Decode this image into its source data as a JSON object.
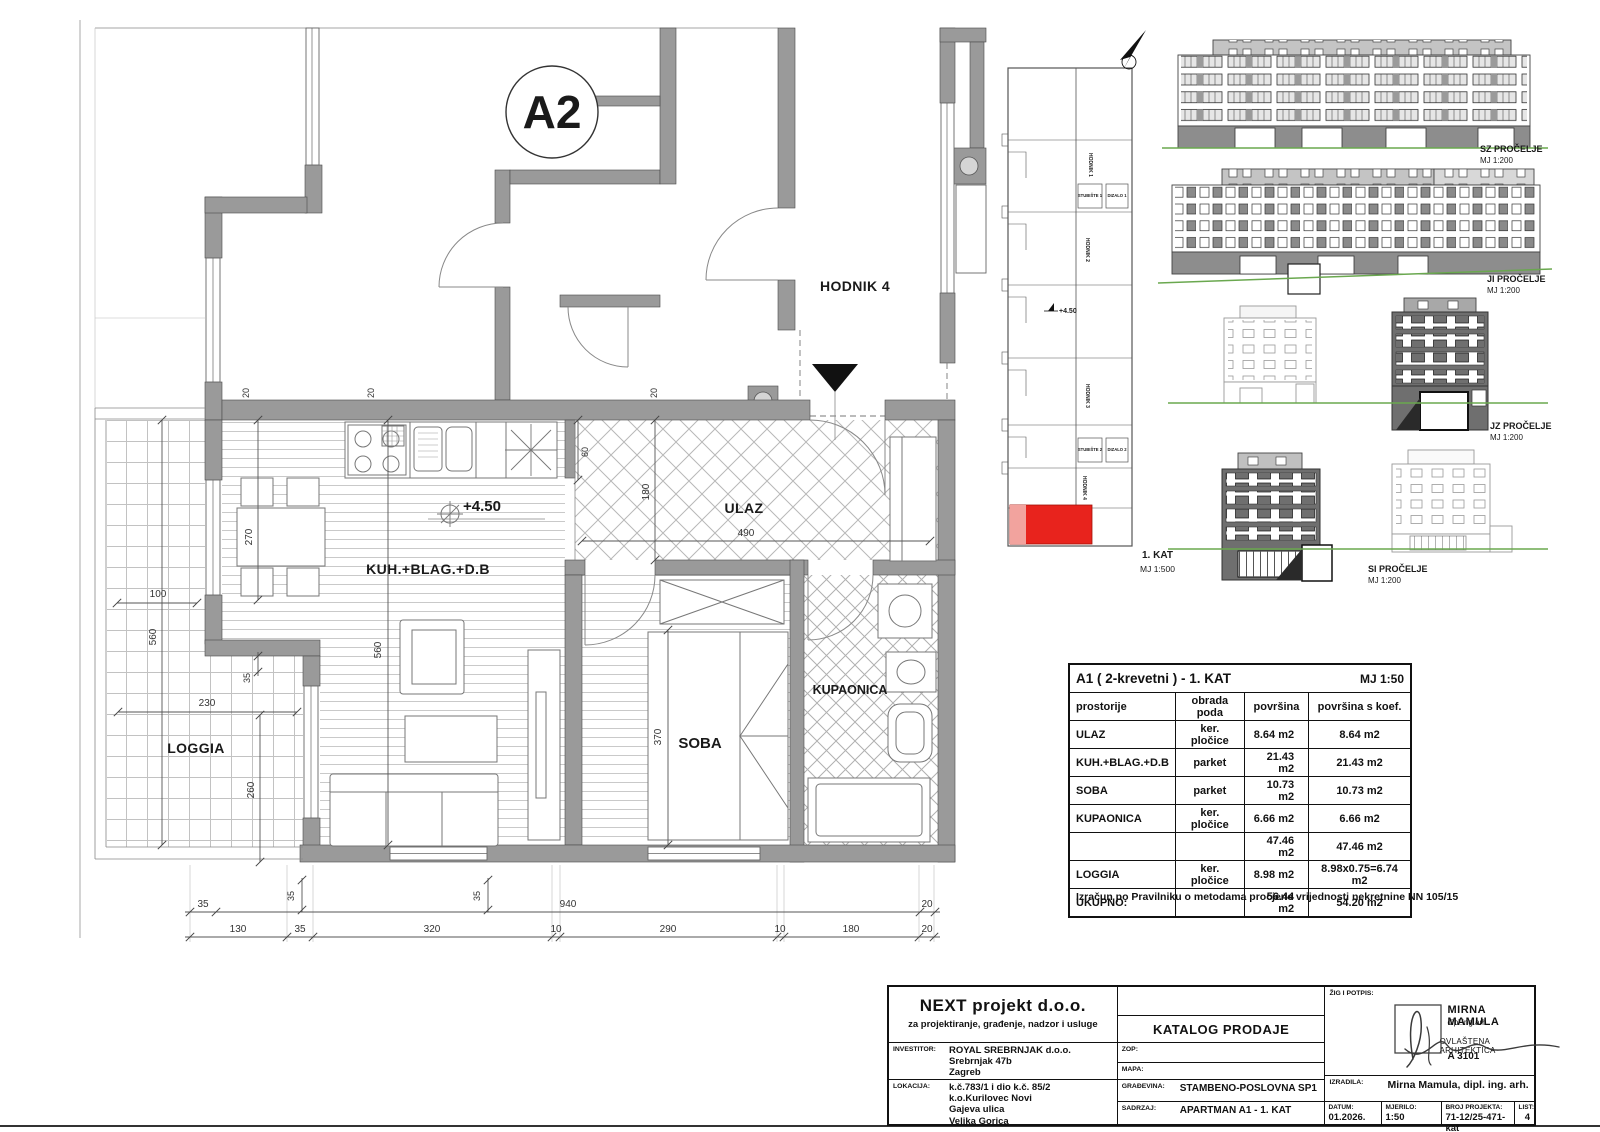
{
  "plan": {
    "badge": "A2",
    "labels": {
      "hodnik4": "HODNIK 4",
      "ulaz": "ULAZ",
      "kuh": "KUH.+BLAG.+D.B",
      "soba": "SOBA",
      "kupaonica": "KUPAONICA",
      "loggia": "LOGGIA",
      "level": "+4.50"
    },
    "dims": {
      "d10": "10",
      "d20": "20",
      "d35": "35",
      "d60": "60",
      "d100": "100",
      "d130": "130",
      "d180": "180",
      "d230": "230",
      "d260": "260",
      "d270": "270",
      "d290": "290",
      "d320": "320",
      "d370": "370",
      "d490": "490",
      "d560": "560",
      "d940": "940"
    }
  },
  "keyplan": {
    "hodnik1": "HODNIK 1",
    "hodnik2": "HODNIK 2",
    "hodnik3": "HODNIK 3",
    "hodnik4": "HODNIK 4",
    "stubiste1": "STUBIŠTE 1",
    "stubiste2": "STUBIŠTE 2",
    "dizalo1": "DIZALO 1",
    "dizalo2": "DIZALO 2",
    "level": "+4.50",
    "floor": "1. KAT",
    "scale": "MJ 1:500",
    "highlight_color": "#e8231d"
  },
  "elevations": {
    "sz": {
      "name": "SZ PROČELJE",
      "scale": "MJ 1:200"
    },
    "ji": {
      "name": "JI PROČELJE",
      "scale": "MJ 1:200"
    },
    "jz": {
      "name": "JZ PROČELJE",
      "scale": "MJ 1:200"
    },
    "si": {
      "name": "SI PROČELJE",
      "scale": "MJ 1:200"
    }
  },
  "table": {
    "title": "A1 ( 2-krevetni ) - 1. KAT",
    "scale": "MJ 1:50",
    "headers": [
      "prostorije",
      "obrada poda",
      "površina",
      "površina s koef."
    ],
    "rows": [
      {
        "name": "ULAZ",
        "floor": "ker. pločice",
        "area": "8.64 m2",
        "coef": "8.64 m2"
      },
      {
        "name": "KUH.+BLAG.+D.B",
        "floor": "parket",
        "area": "21.43 m2",
        "coef": "21.43 m2"
      },
      {
        "name": "SOBA",
        "floor": "parket",
        "area": "10.73 m2",
        "coef": "10.73 m2"
      },
      {
        "name": "KUPAONICA",
        "floor": "ker. pločice",
        "area": "6.66 m2",
        "coef": "6.66 m2"
      },
      {
        "name": "",
        "floor": "",
        "area": "47.46 m2",
        "coef": "47.46 m2"
      },
      {
        "name": "LOGGIA",
        "floor": "ker. pločice",
        "area": "8.98 m2",
        "coef": "8.98x0.75=6.74 m2"
      },
      {
        "name": "UKUPNO:",
        "floor": "",
        "area": "56.44 m2",
        "coef": "54.20 m2"
      }
    ],
    "note": "Izračun po Pravilniku o metodama procjene vrijednosti nekretnine  NN 105/15"
  },
  "titleblock": {
    "company": "NEXT projekt d.o.o.",
    "company_sub": "za projektiranje, građenje, nadzor i usluge",
    "investitor_label": "INVESTITOR:",
    "investitor": [
      "ROYAL SREBRNJAK d.o.o.",
      "Srebrnjak 47b",
      "Zagreb"
    ],
    "lokacija_label": "LOKACIJA:",
    "lokacija": [
      "k.č.783/1 i dio k.č. 85/2",
      "k.o.Kurilovec Novi",
      "Gajeva ulica",
      "Velika Gorica"
    ],
    "katalog": "KATALOG PRODAJE",
    "zop_label": "ZOP:",
    "mapa_label": "MAPA:",
    "gradevina_label": "GRAĐEVINA:",
    "gradevina": "STAMBENO-POSLOVNA SP1",
    "sadrzaj_label": "SADRZAJ:",
    "sadrzaj": "APARTMAN A1 - 1. KAT",
    "zig_label": "ŽIG I POTPIS:",
    "stamp_name": "MIRNA MAMULA",
    "stamp_title": "dipl.ing.arh.",
    "stamp_role": "OVLAŠTENA ARHITEKTICA",
    "stamp_id": "A 3101",
    "izradila_label": "IZRADILA:",
    "izradila": "Mirna Mamula, dipl. ing. arh.",
    "datum_label": "DATUM:",
    "datum": "01.2026.",
    "mjerilo_label": "MJERILO:",
    "mjerilo": "1:50",
    "broj_label": "BROJ PROJEKTA:",
    "broj": "71-12/25-471-kat",
    "list_label": "LIST:",
    "list": "4"
  }
}
